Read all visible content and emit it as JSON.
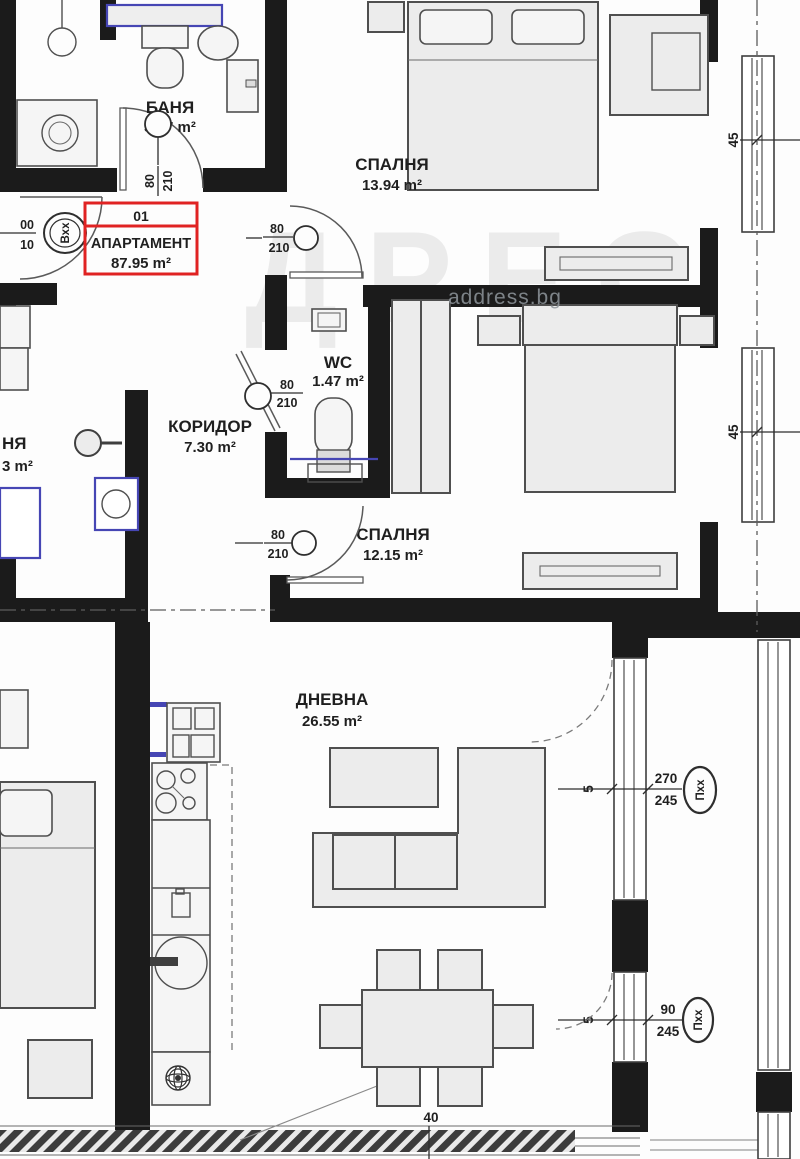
{
  "plan": {
    "apartment": {
      "number": "01",
      "title": "АПАРТАМЕНТ",
      "area": "87.95 m²"
    },
    "rooms": {
      "bathroom": {
        "name": "БАНЯ",
        "area": "3.37 m²"
      },
      "bedroom1": {
        "name": "СПАЛНЯ",
        "area": "13.94 m²"
      },
      "wc": {
        "name": "WC",
        "area": "1.47 m²"
      },
      "corridor": {
        "name": "КОРИДОР",
        "area": "7.30 m²"
      },
      "bedroom2": {
        "name": "СПАЛНЯ",
        "area": "12.15 m²"
      },
      "living": {
        "name": "ДНЕВНА",
        "area": "26.55 m²"
      }
    },
    "doors": {
      "bathroom": {
        "w": "80",
        "h": "210"
      },
      "bedroom1": {
        "w": "80",
        "h": "210"
      },
      "wc": {
        "w": "80",
        "h": "210"
      },
      "bedroom2": {
        "w": "80",
        "h": "210"
      }
    },
    "entrance": {
      "w": "00",
      "h": "10",
      "code": "Вхх"
    },
    "windows": {
      "large": {
        "w": "270",
        "h": "245",
        "code": "Пхх"
      },
      "small": {
        "w": "90",
        "h": "245",
        "code": "Пхх"
      }
    },
    "dimensions": {
      "right_upper": "45",
      "right_lower": "45",
      "balcony_upper": "5",
      "balcony_lower": "5",
      "bottom": "40"
    },
    "neighbor": {
      "room": "НЯ",
      "area": "3 m²"
    },
    "watermark": {
      "small": "address.bg",
      "big": "ДРЕС"
    },
    "colors": {
      "wall": "#1b1b1b",
      "accent_blue": "#4646b4",
      "highlight_red": "#e02222",
      "furniture_fill": "#ececec"
    }
  }
}
